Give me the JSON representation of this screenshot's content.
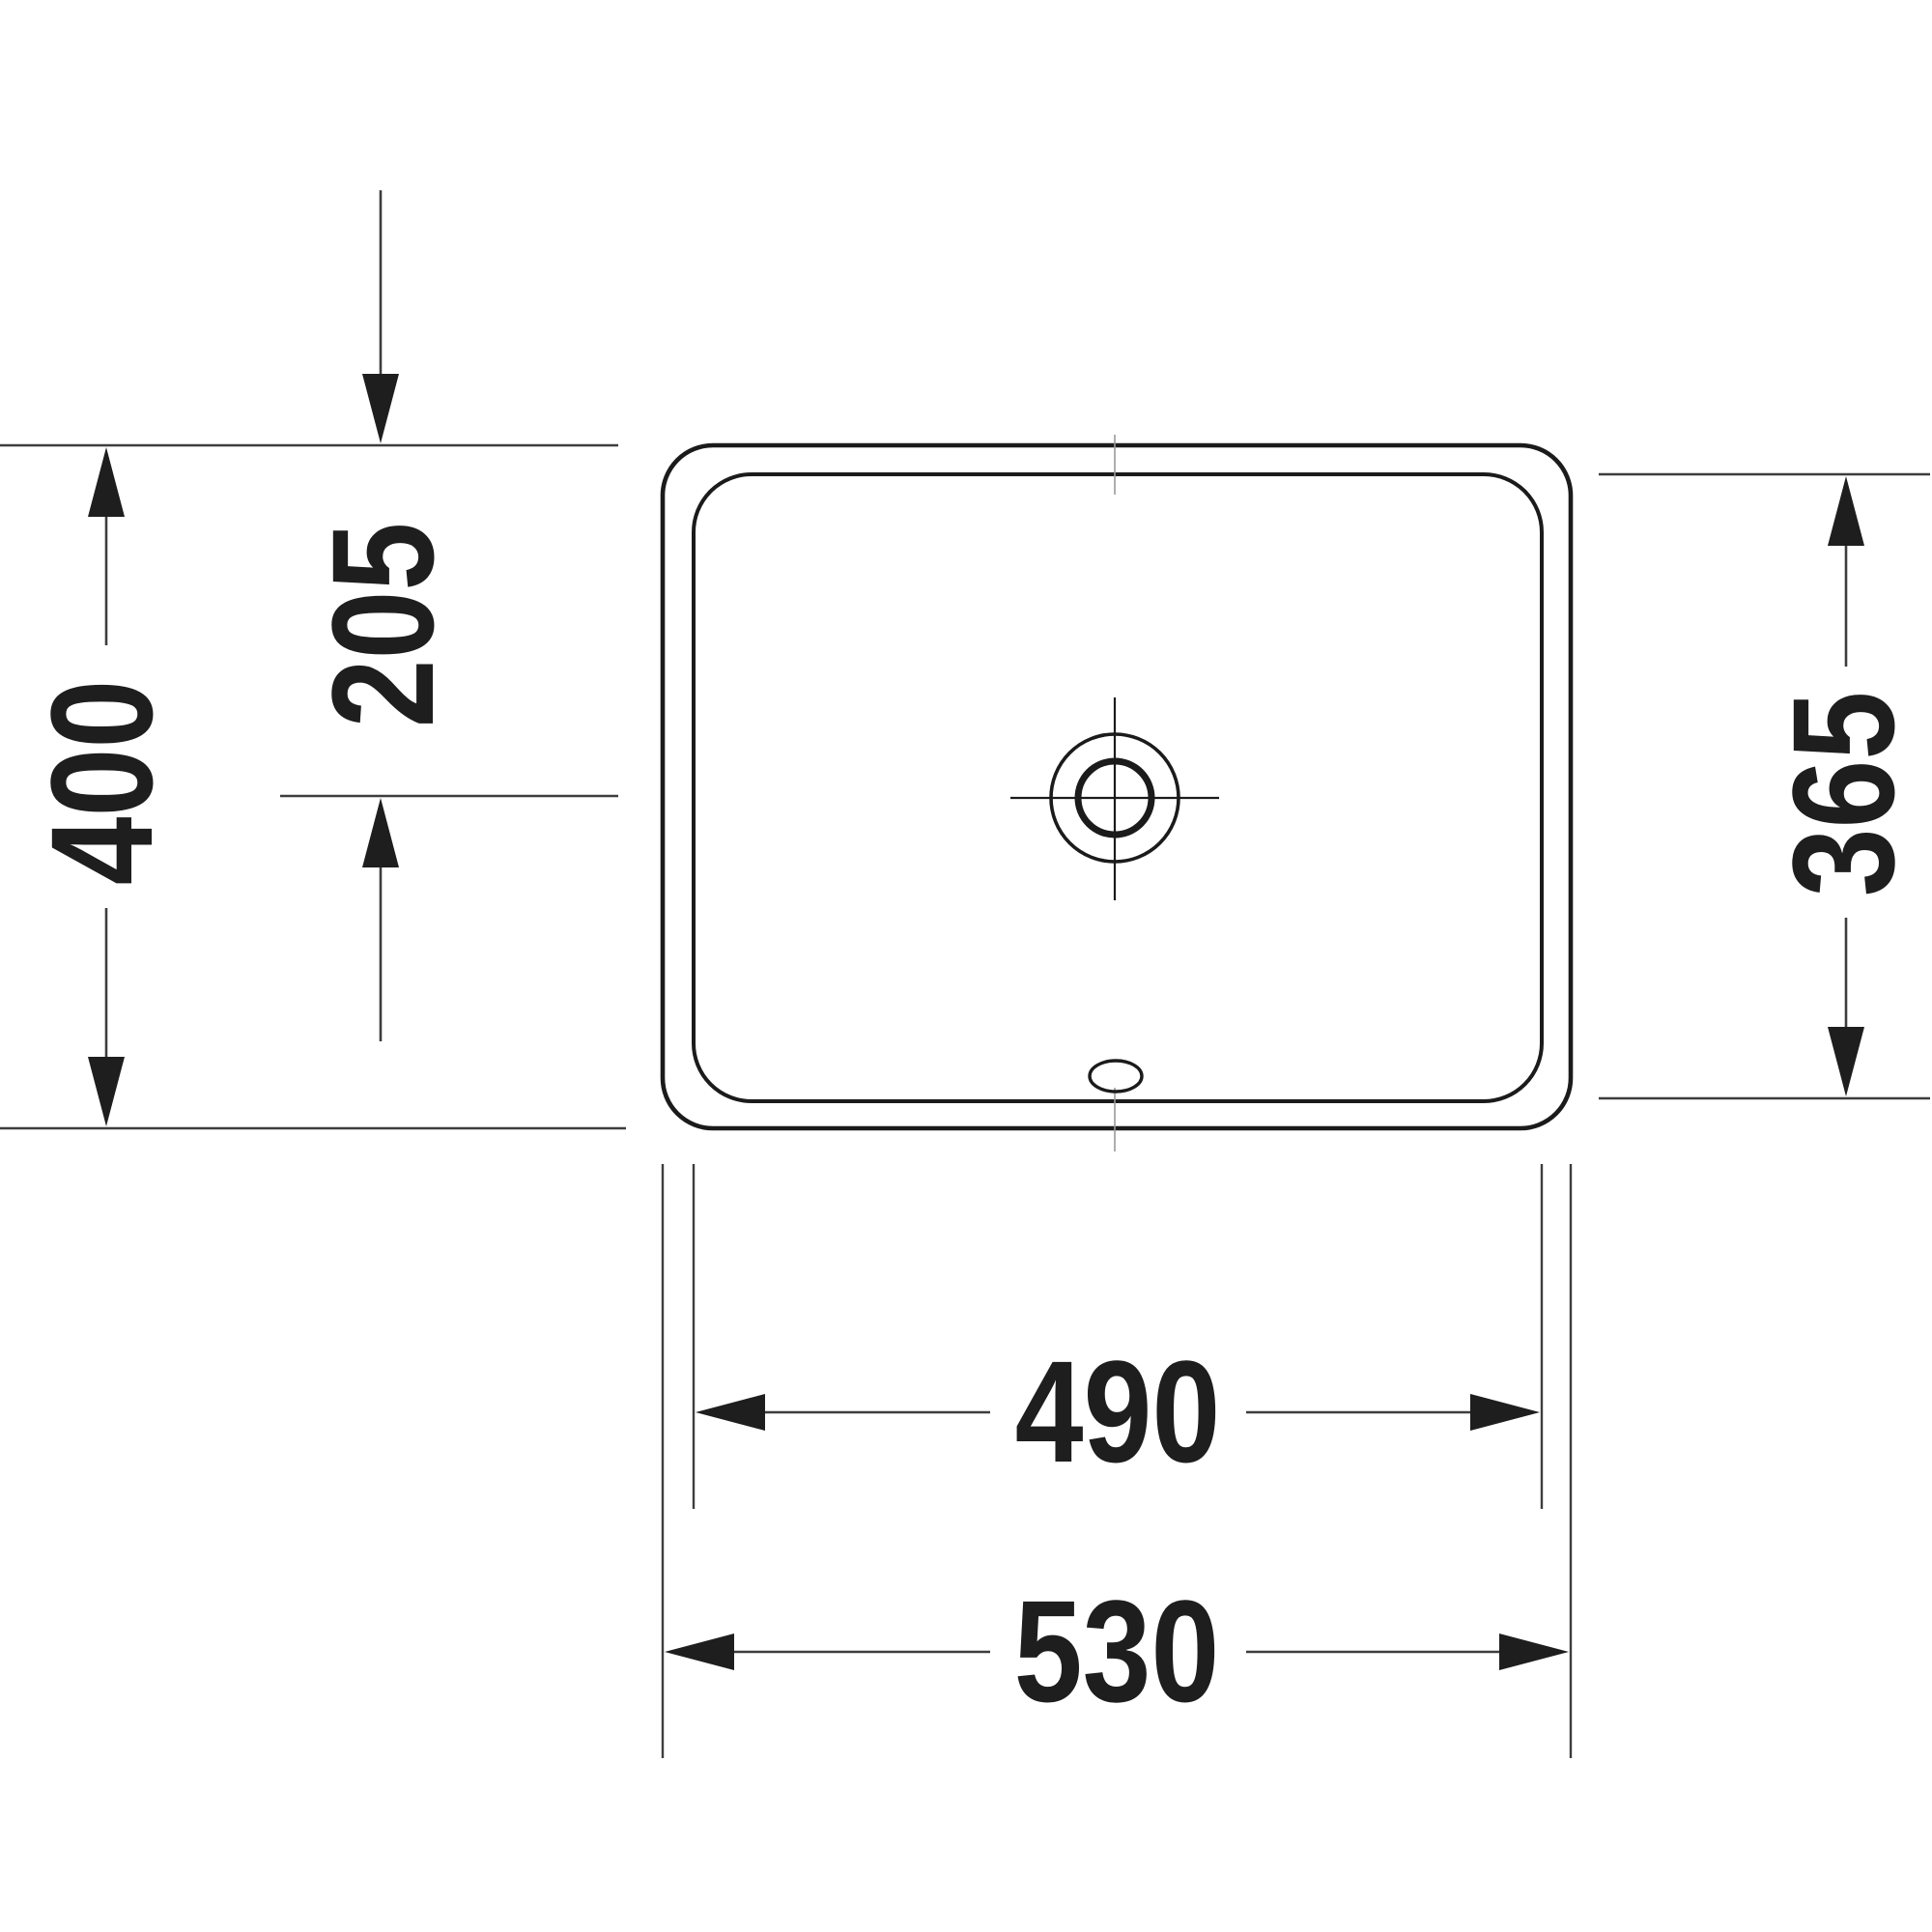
{
  "drawing": {
    "type": "technical-dimension-drawing",
    "subject": "rectangular washbasin top view",
    "labels": {
      "drain_center_offset": "205",
      "overall_depth": "400",
      "bowl_depth": "365",
      "bowl_width": "490",
      "overall_width": "530"
    },
    "colors": {
      "background": "#ffffff",
      "outline": "#1b1b1b",
      "dimension": "#3d3d3d",
      "text": "#1e1e1e",
      "tick": "#9a9a9a"
    }
  }
}
